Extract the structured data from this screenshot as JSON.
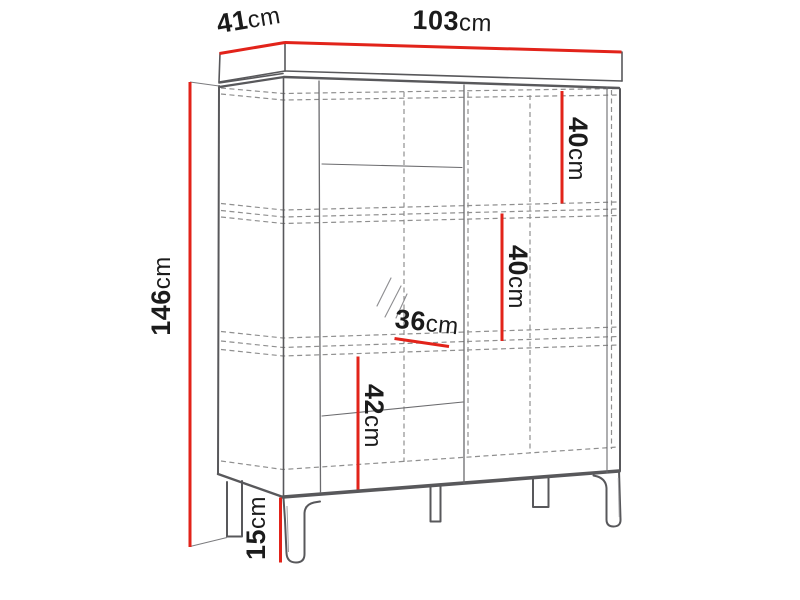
{
  "diagram": {
    "kind": "furniture-dimension-diagram",
    "subject": "display cabinet with legs, front-left perspective line drawing",
    "background": "#ffffff",
    "colors": {
      "dimension_line": "#e2231a",
      "outline": "#58585b",
      "hidden_edge": "#8f8f8f",
      "label_text": "#1b1b1b"
    },
    "dimensions": {
      "width": {
        "value": "103",
        "unit": "cm"
      },
      "depth": {
        "value": "41",
        "unit": "cm"
      },
      "height": {
        "value": "146",
        "unit": "cm"
      },
      "top_section": {
        "value": "40",
        "unit": "cm"
      },
      "middle_section": {
        "value": "40",
        "unit": "cm"
      },
      "shelf_depth": {
        "value": "36",
        "unit": "cm"
      },
      "lower_section": {
        "value": "42",
        "unit": "cm"
      },
      "leg_height": {
        "value": "15",
        "unit": "cm"
      }
    }
  }
}
